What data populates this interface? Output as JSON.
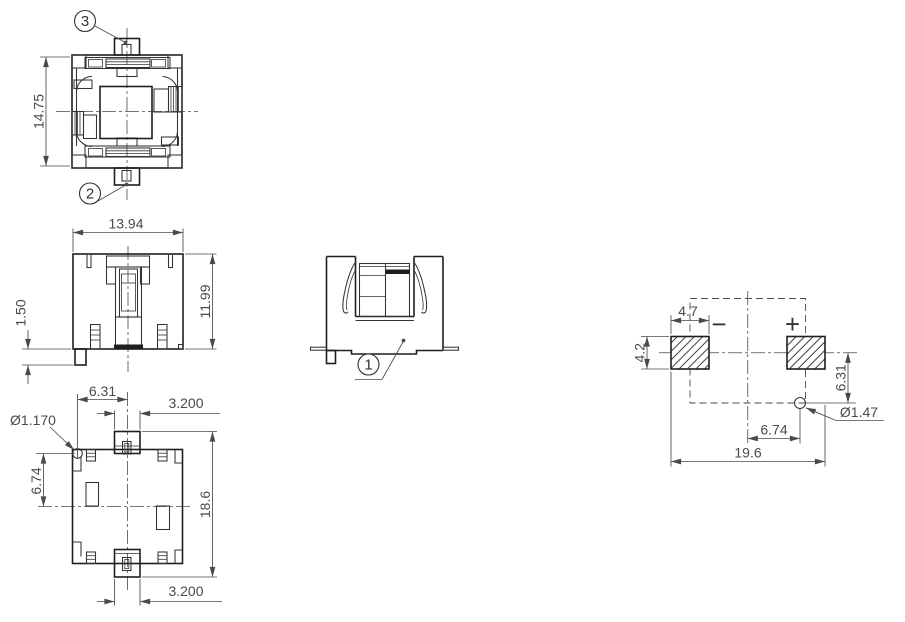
{
  "colors": {
    "outline": "#1e1e1e",
    "detail": "#333333",
    "dimension": "#4a4a4a",
    "hatch": "#3f3f3f",
    "background": "#ffffff"
  },
  "views": {
    "top": {
      "dim_height": "14.75",
      "balloon_top": "3",
      "balloon_bottom": "2"
    },
    "front": {
      "dim_width": "13.94",
      "dim_height": "11.99",
      "dim_leg_height": "1.50"
    },
    "bottom": {
      "dim_hole_offset_x": "6.31",
      "dim_top_tab_width": "3.200",
      "dim_hole_diameter": "Ø1.170",
      "dim_hole_offset_y": "6.74",
      "dim_overall_height": "18.6",
      "dim_bottom_tab_width": "3.200"
    },
    "side": {
      "balloon_part": "1"
    },
    "land_pattern": {
      "dim_pad_width": "4.7",
      "dim_pad_height": "4.2",
      "polarity_negative": "−",
      "polarity_positive": "+",
      "dim_hole_offset_y": "6.31",
      "dim_hole_offset_x": "6.74",
      "dim_overall_span": "19.6",
      "dim_hole_diameter": "Ø1.47"
    }
  }
}
